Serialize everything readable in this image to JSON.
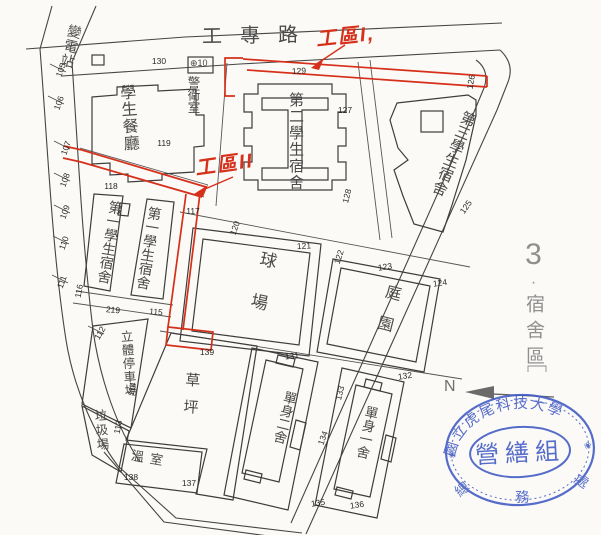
{
  "page": {
    "ink": "#454545",
    "red": "#d6301b",
    "blue": "#3f58c4",
    "gray": "#8f8f8f"
  },
  "road": {
    "name": "工專路"
  },
  "area_label": {
    "index": "3",
    "dot": "·",
    "name": "宿舍區"
  },
  "north": {
    "label": "N"
  },
  "work_zones": {
    "zone1": "工區I,",
    "zone2": "工區II"
  },
  "buildings": {
    "substation": "變電站",
    "cafeteria": "學生餐廳",
    "guard": "警衛室",
    "guard_no": "⊕10",
    "dorm2": "第二學生宿舍",
    "dorm3": "第三學生宿舍",
    "dorm1a": "第一學生宿舍",
    "dorm1b": "第一學生宿舍",
    "court": "球場",
    "garden": "庭園",
    "parking": "立體停車場",
    "garbage": "垃圾場",
    "lawn": "草坪",
    "greenhouse": "溫室",
    "single2": "單身二舍",
    "single1": "單身一舍"
  },
  "stamp": {
    "university": "國立虎尾科技大學",
    "division": "營繕組",
    "office_chars": [
      "總",
      "務",
      "處"
    ],
    "flower": "❀"
  },
  "markers": [
    {
      "v": "105",
      "x": 61,
      "y": 70,
      "r": -70
    },
    {
      "v": "106",
      "x": 59,
      "y": 103,
      "r": -70
    },
    {
      "v": "107",
      "x": 66,
      "y": 148,
      "r": -70
    },
    {
      "v": "108",
      "x": 65,
      "y": 180,
      "r": -70
    },
    {
      "v": "109",
      "x": 65,
      "y": 212,
      "r": -70
    },
    {
      "v": "110",
      "x": 64,
      "y": 243,
      "r": -70
    },
    {
      "v": "111",
      "x": 62,
      "y": 282,
      "r": -70
    },
    {
      "v": "112",
      "x": 100,
      "y": 333,
      "r": -60
    },
    {
      "v": "113",
      "x": 118,
      "y": 427,
      "r": -80
    },
    {
      "v": "114",
      "x": 132,
      "y": 389,
      "r": -80
    },
    {
      "v": "116",
      "x": 79,
      "y": 291,
      "r": -80
    },
    {
      "v": "219",
      "x": 113,
      "y": 310,
      "r": 5
    },
    {
      "v": "115",
      "x": 156,
      "y": 312,
      "r": 5
    },
    {
      "v": "117",
      "x": 193,
      "y": 211,
      "r": 0
    },
    {
      "v": "118",
      "x": 111,
      "y": 186,
      "r": 0
    },
    {
      "v": "119",
      "x": 164,
      "y": 143,
      "r": 0
    },
    {
      "v": "130",
      "x": 159,
      "y": 61,
      "r": 0
    },
    {
      "v": "129",
      "x": 299,
      "y": 71,
      "r": -3
    },
    {
      "v": "127",
      "x": 345,
      "y": 110,
      "r": 0
    },
    {
      "v": "128",
      "x": 347,
      "y": 196,
      "r": -75
    },
    {
      "v": "126",
      "x": 471,
      "y": 82,
      "r": -80
    },
    {
      "v": "125",
      "x": 466,
      "y": 207,
      "r": -55
    },
    {
      "v": "120",
      "x": 235,
      "y": 228,
      "r": -70
    },
    {
      "v": "121",
      "x": 304,
      "y": 246,
      "r": -3
    },
    {
      "v": "122",
      "x": 339,
      "y": 257,
      "r": -72
    },
    {
      "v": "123",
      "x": 385,
      "y": 267,
      "r": -8
    },
    {
      "v": "124",
      "x": 440,
      "y": 283,
      "r": -8
    },
    {
      "v": "132",
      "x": 405,
      "y": 376,
      "r": -8
    },
    {
      "v": "131",
      "x": 292,
      "y": 356,
      "r": -5
    },
    {
      "v": "133",
      "x": 340,
      "y": 393,
      "r": -75
    },
    {
      "v": "134",
      "x": 323,
      "y": 438,
      "r": -70
    },
    {
      "v": "135",
      "x": 318,
      "y": 503,
      "r": -8
    },
    {
      "v": "136",
      "x": 357,
      "y": 505,
      "r": -8
    },
    {
      "v": "137",
      "x": 189,
      "y": 483,
      "r": 0
    },
    {
      "v": "138",
      "x": 131,
      "y": 477,
      "r": 0
    },
    {
      "v": "139",
      "x": 207,
      "y": 352,
      "r": 0
    }
  ]
}
